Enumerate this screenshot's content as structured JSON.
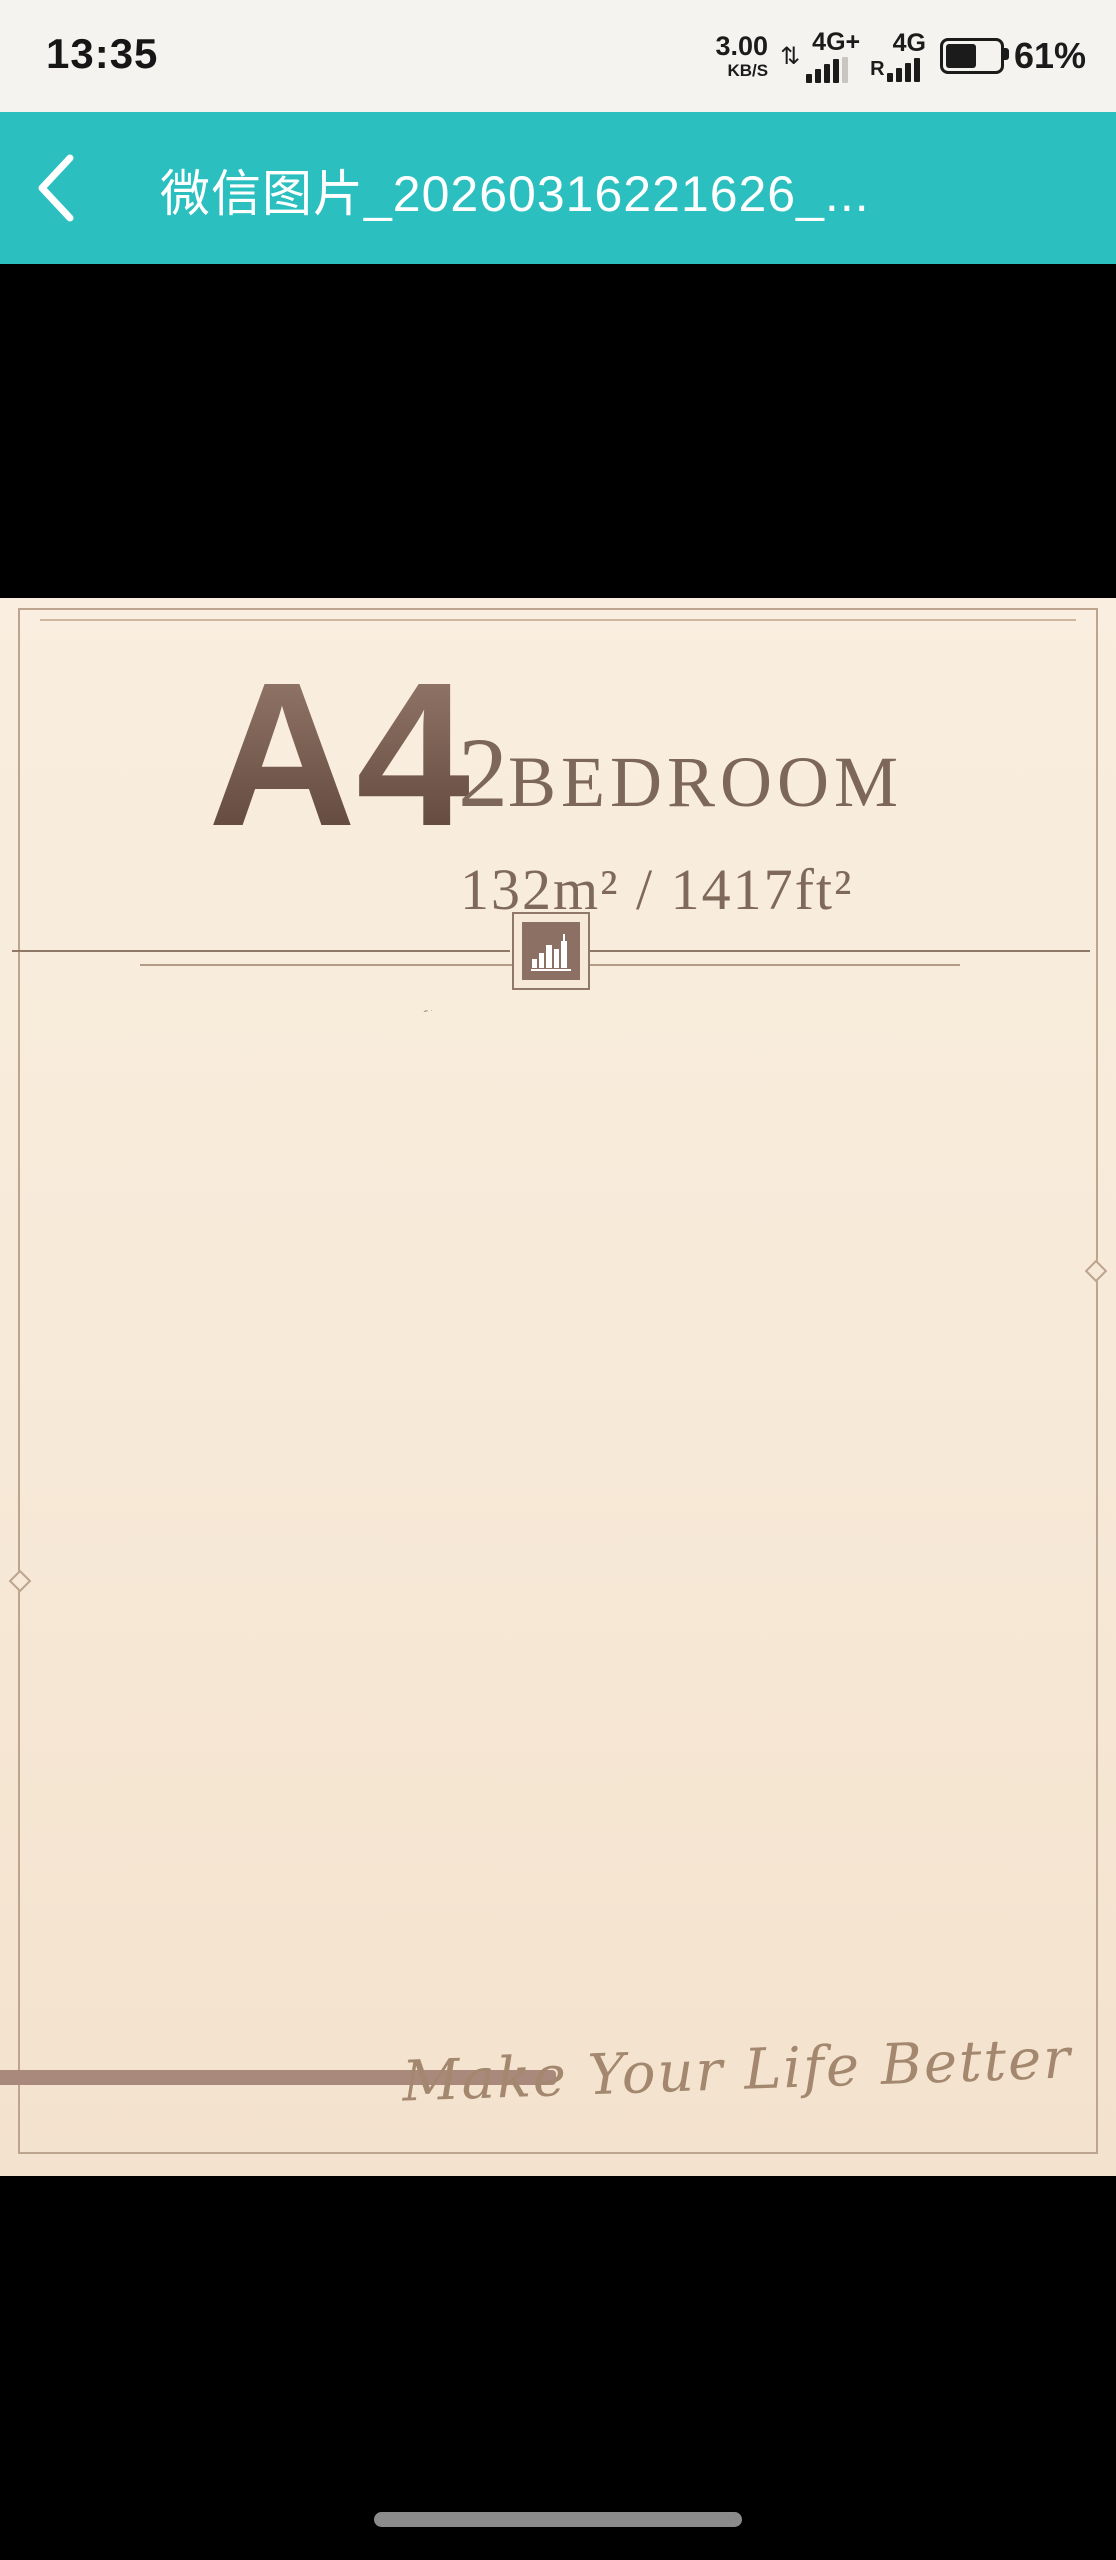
{
  "status_bar": {
    "time": "13:35",
    "net_speed": "3.00",
    "net_speed_unit": "KB/S",
    "updown_arrows_icon": "⇅",
    "network1_label": "4G+",
    "network2_label": "4G",
    "roaming_label": "R",
    "battery_percent": "61%",
    "icons": [
      "updown-arrows-icon",
      "signal-bars-icon",
      "signal-bars-icon",
      "battery-icon"
    ]
  },
  "header": {
    "back_icon": "chevron-left",
    "title": "微信图片_20260316221626_..."
  },
  "poster": {
    "unit": "A4",
    "bedroom_count": "2",
    "bedroom_label": "BEDROOM",
    "area": "132m² / 1417ft²",
    "slogan": "Make Your Life Better",
    "logo_icon": "building-skyline-icon"
  },
  "plan": {
    "room_labels": [
      "Balcony",
      "Balcony",
      "Master Bedroom",
      "Bathroom",
      "Living Room",
      "Balcony",
      "Bathroom",
      "Dining Room",
      "Secondary Bedroom",
      "Kitchen",
      "Balcony"
    ],
    "dims": {
      "top": [
        "1700",
        "3300",
        "5600"
      ],
      "left": [
        "1700",
        "4200",
        "2525",
        "3100"
      ],
      "right": [
        "1700",
        "6200"
      ],
      "bottom": [
        "1700",
        "3800",
        "3000"
      ]
    }
  },
  "colors": {
    "accent_teal": "#2bbfbf",
    "poster_bg": "#f8ecdc",
    "wall": "#55534c",
    "wood_floor": "#d8c5aa",
    "title_brown": "#76594a",
    "dim_text": "#9c8a77",
    "slogan_text": "#a3886f"
  }
}
